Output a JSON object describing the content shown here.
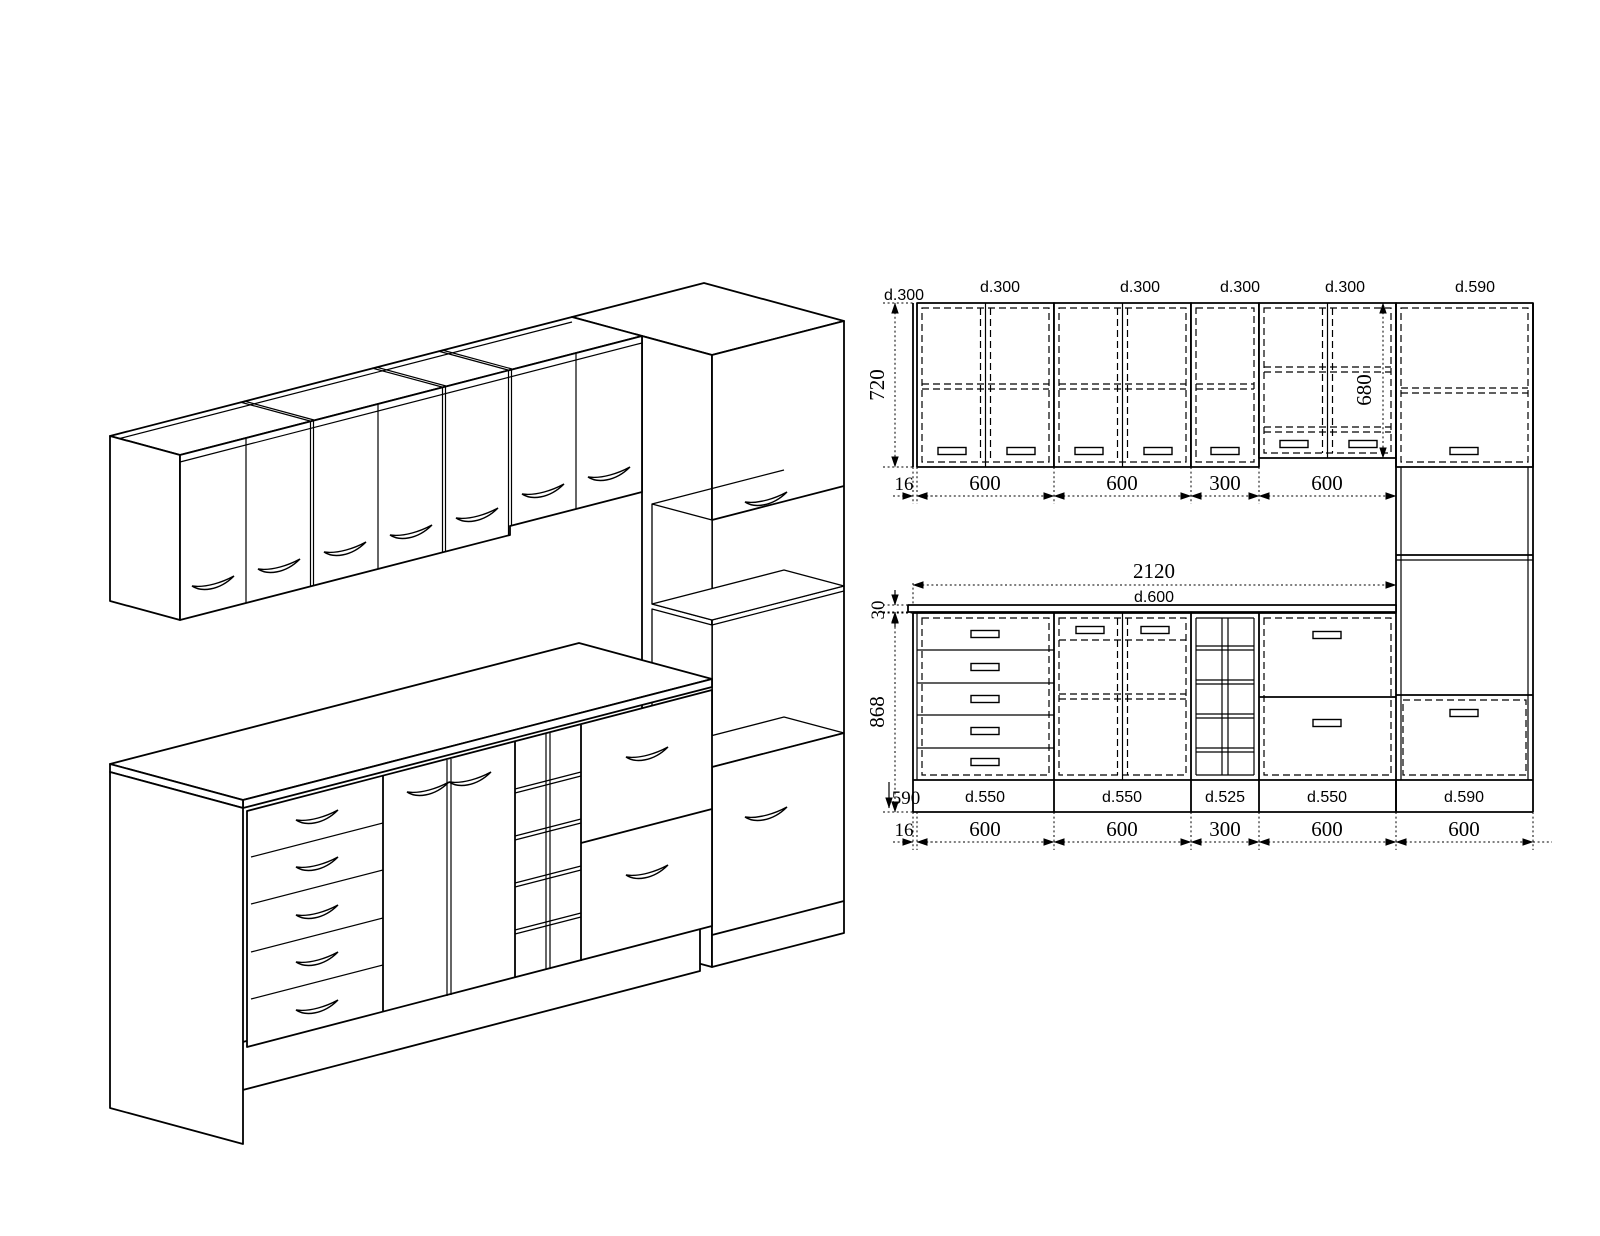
{
  "drawing": {
    "wall_elevation": {
      "depth_labels": [
        "d.300",
        "d.300",
        "d.300",
        "d.300",
        "d.300",
        "d.590"
      ],
      "height_dim": "720",
      "inner_height_dim": "680",
      "width_dims": [
        "16",
        "600",
        "600",
        "300",
        "600"
      ]
    },
    "base_elevation": {
      "total_width_dim": "2120",
      "countertop_depth_label": "d.600",
      "countertop_thickness_dim": "30",
      "height_dim": "868",
      "plinth_depth_dim": "590",
      "unit_depth_labels": [
        "d.550",
        "d.550",
        "d.525",
        "d.550",
        "d.590"
      ],
      "width_dims": [
        "16",
        "600",
        "600",
        "300",
        "600",
        "600"
      ]
    }
  }
}
